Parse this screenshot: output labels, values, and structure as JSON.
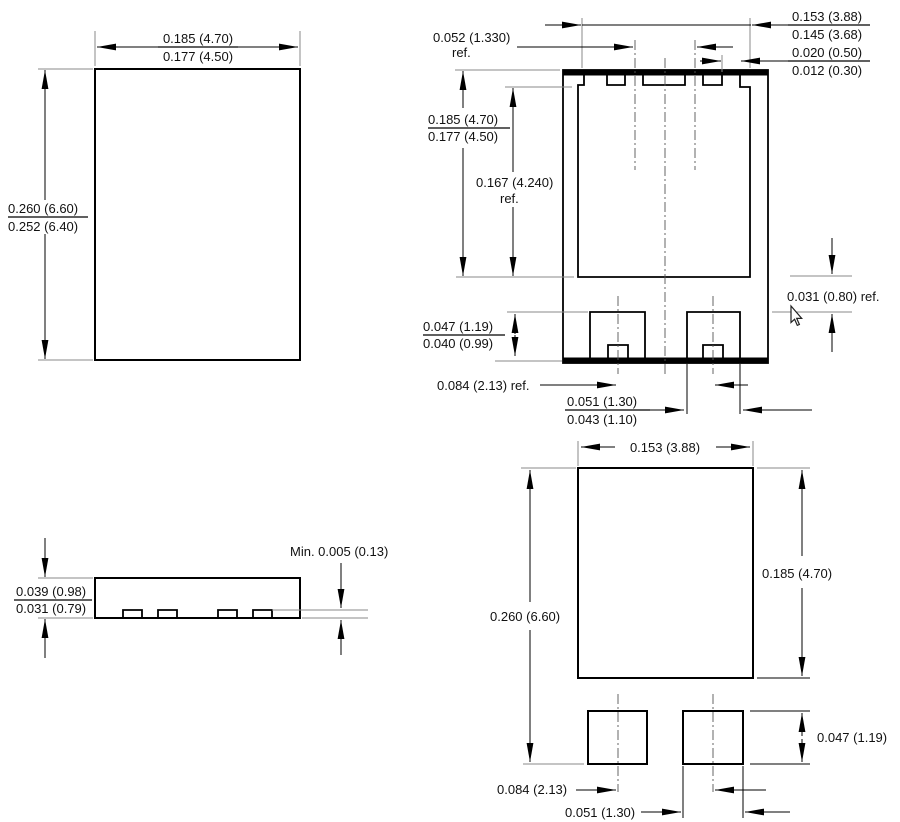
{
  "drawing": {
    "top_view": {
      "width_max": "0.185 (4.70)",
      "width_min": "0.177 (4.50)",
      "height_max": "0.260 (6.60)",
      "height_min": "0.252 (6.40)"
    },
    "bottom_view": {
      "terminal_width_max": "0.153 (3.88)",
      "terminal_width_min": "0.145 (3.68)",
      "notch_max": "0.020 (0.50)",
      "notch_min": "0.012 (0.30)",
      "notch_pitch": "0.052 (1.330)",
      "notch_pitch_suffix": "ref.",
      "pad_length_max": "0.185 (4.70)",
      "pad_length_min": "0.177 (4.50)",
      "inner_length": "0.167 (4.240)",
      "inner_length_suffix": "ref.",
      "terminal_height_max": "0.047 (1.19)",
      "terminal_height_min": "0.040 (0.99)",
      "gap_ref": "0.031 (0.80) ref.",
      "pitch_ref": "0.084 (2.13) ref.",
      "terminal_width2_max": "0.051 (1.30)",
      "terminal_width2_min": "0.043 (1.10)"
    },
    "side_view": {
      "thickness_max": "0.039 (0.98)",
      "thickness_min": "0.031 (0.79)",
      "standoff_min": "Min. 0.005 (0.13)"
    },
    "land_pattern": {
      "pad_area_width": "0.153 (3.88)",
      "overall_length": "0.260 (6.60)",
      "large_pad_length": "0.185 (4.70)",
      "small_pad_height": "0.047 (1.19)",
      "pad_pitch": "0.084 (2.13)",
      "small_pad_width": "0.051 (1.30)"
    },
    "colors": {
      "ink": "#000000",
      "extension_line": "#8a8a8a",
      "background": "#ffffff"
    }
  }
}
